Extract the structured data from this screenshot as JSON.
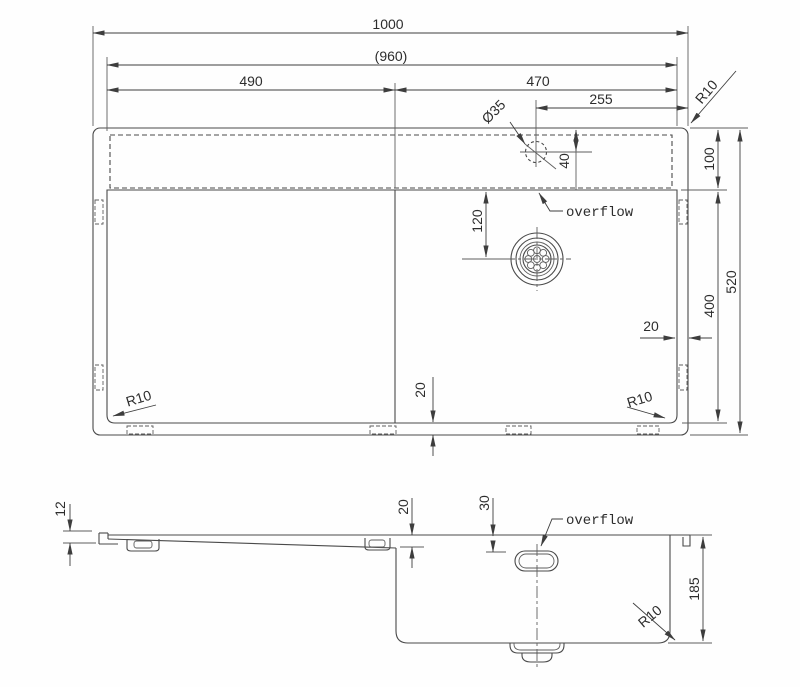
{
  "drawing": {
    "kind": "sink technical drawing, plan view and section view",
    "dims": {
      "overall_width": "1000",
      "inner_width": "(960)",
      "drainboard_width": "490",
      "bowl_width": "470",
      "tap_hole_offset": "255",
      "tap_hole_diameter": "Ø35",
      "tap_hole_inset": "40",
      "deck_band_height": "100",
      "bowl_front_depth": "400",
      "overall_depth": "520",
      "drain_inset": "120",
      "rim_side_gap": "20",
      "rim_bottom_gap": "20",
      "corner_radius": "R10",
      "drainboard_edge_height": "12",
      "drainboard_drop": "20",
      "overflow_inset": "30",
      "bowl_depth": "185"
    },
    "labels": {
      "overflow": "overflow"
    }
  }
}
